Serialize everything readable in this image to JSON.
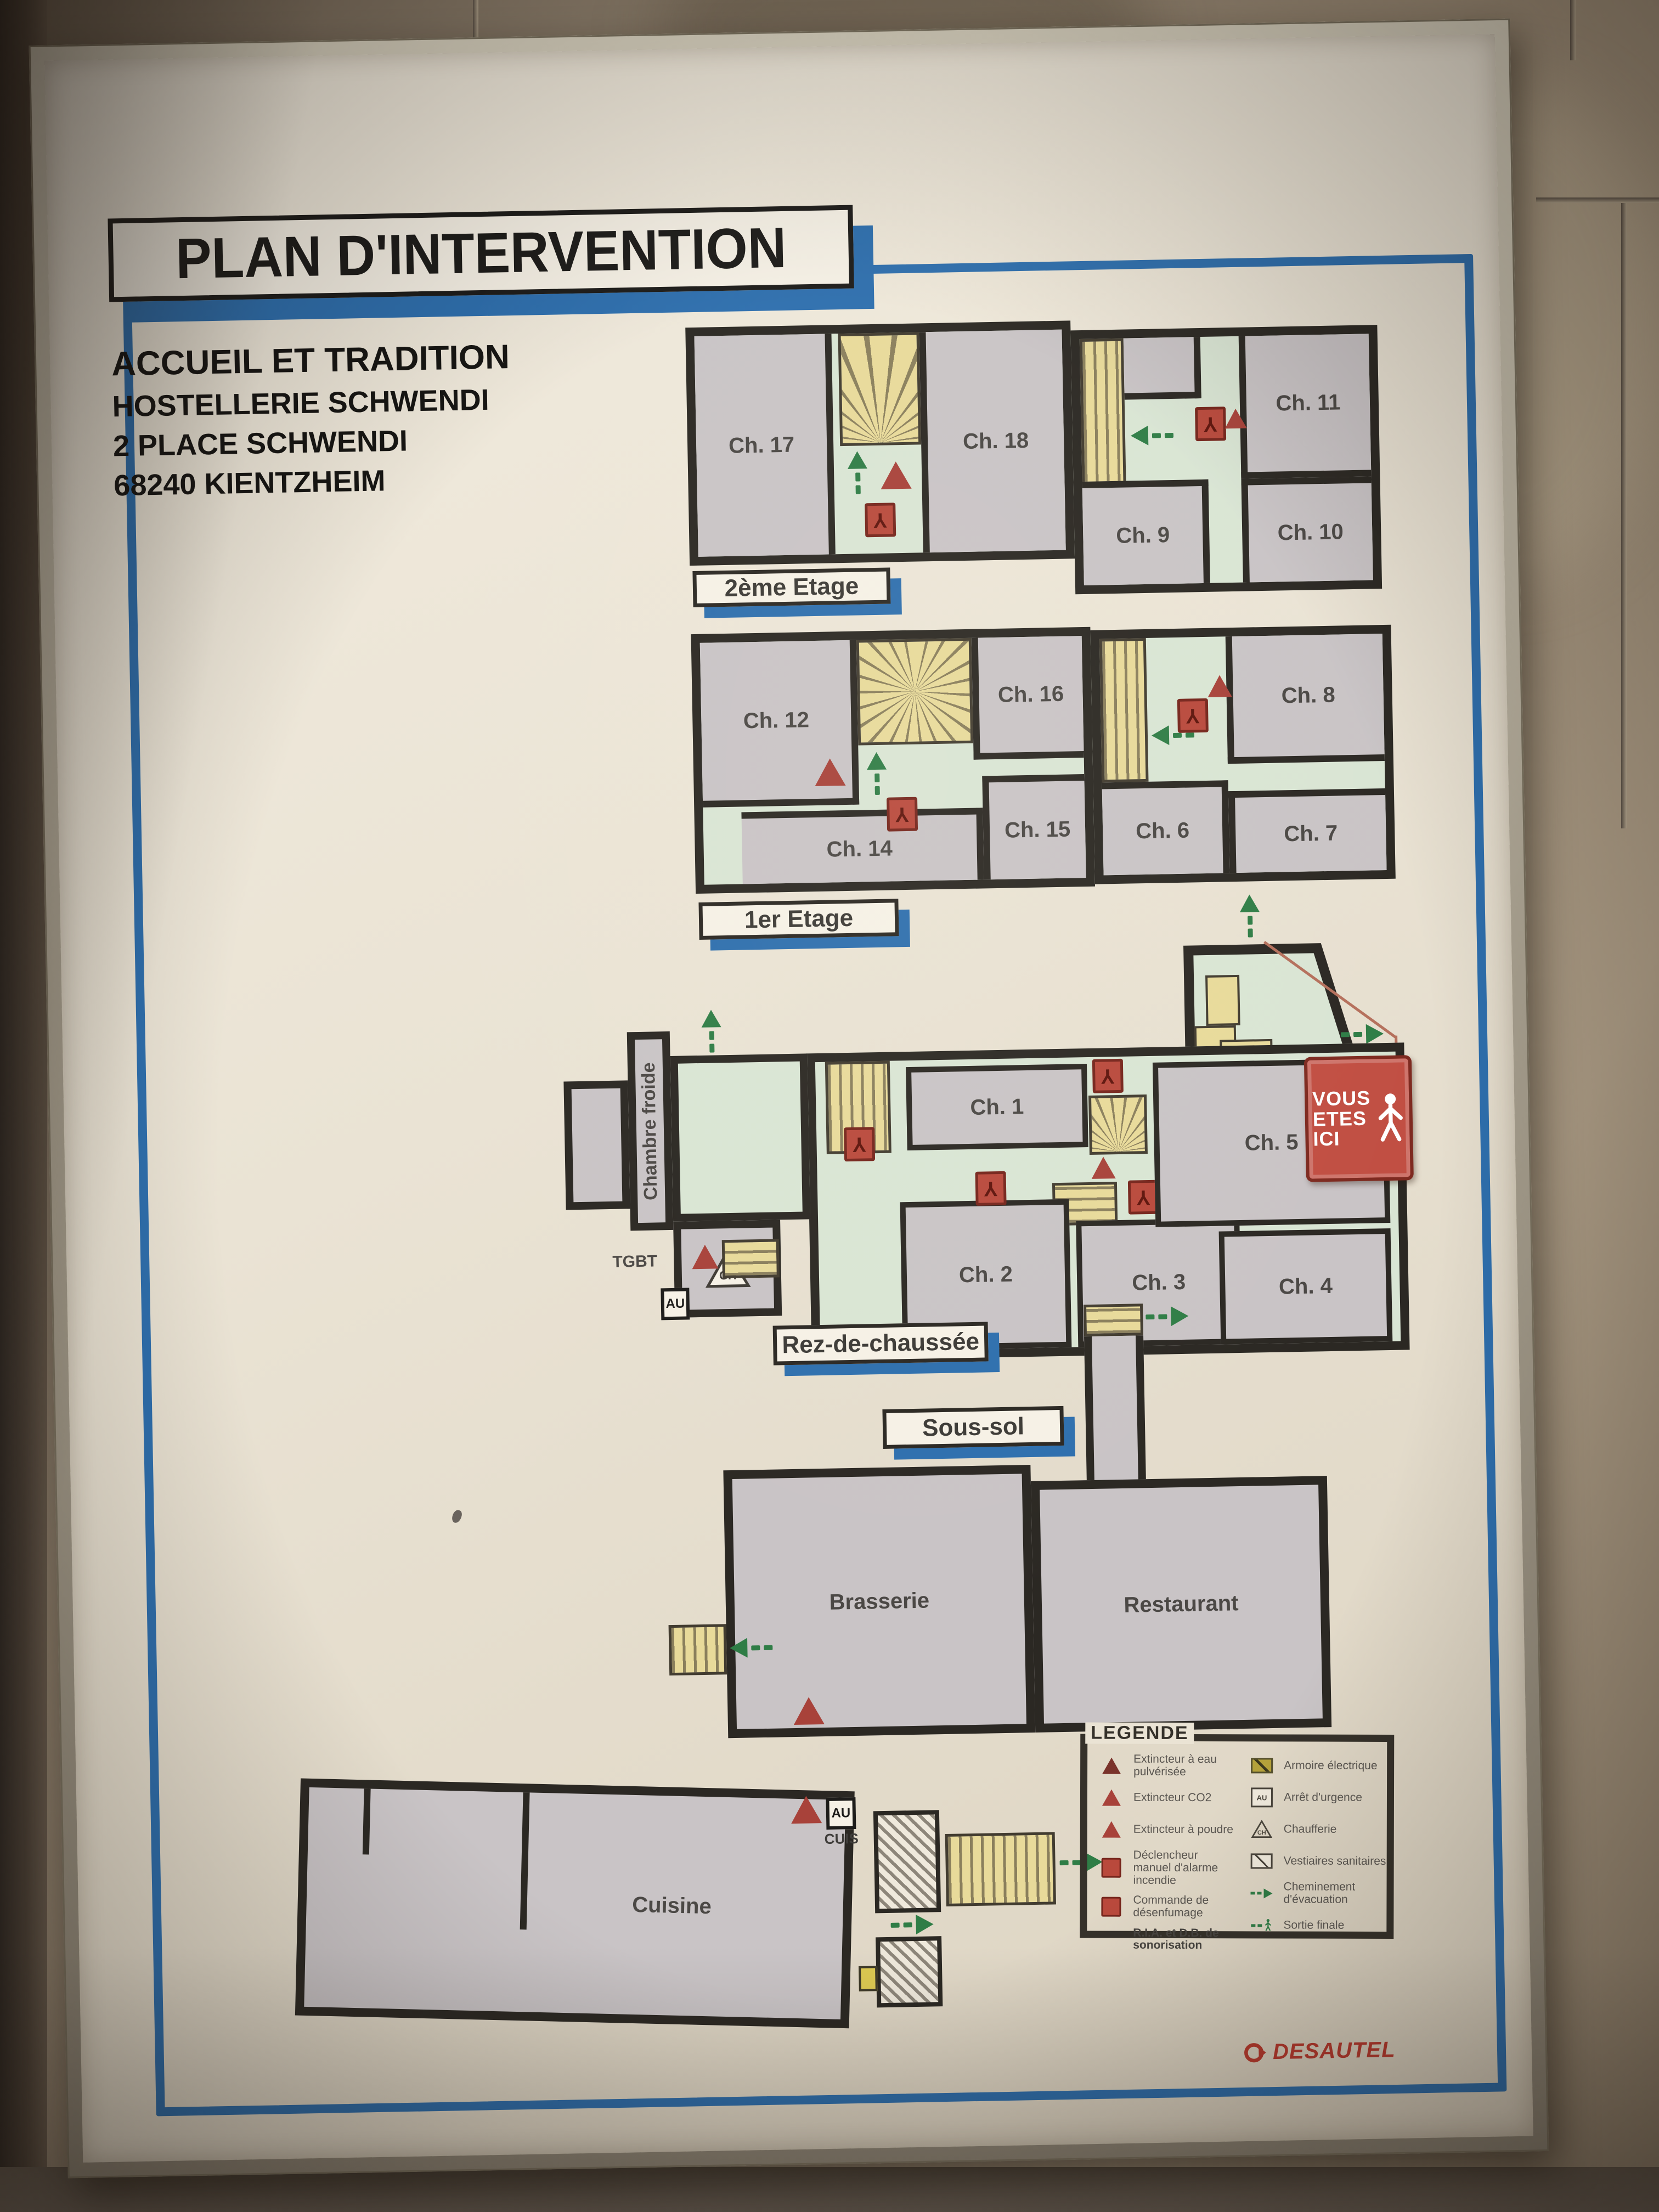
{
  "title": "PLAN D'INTERVENTION",
  "address": [
    "ACCUEIL ET TRADITION",
    "HOSTELLERIE SCHWENDI",
    "2 PLACE SCHWENDI",
    "68240 KIENTZHEIM"
  ],
  "floors": {
    "etage2": "2ème Etage",
    "etage1": "1er Etage",
    "rdc": "Rez-de-chaussée",
    "soussol": "Sous-sol"
  },
  "rooms": {
    "ch1": "Ch. 1",
    "ch2": "Ch. 2",
    "ch3": "Ch. 3",
    "ch4": "Ch. 4",
    "ch5": "Ch. 5",
    "ch6": "Ch. 6",
    "ch7": "Ch. 7",
    "ch8": "Ch. 8",
    "ch9": "Ch. 9",
    "ch10": "Ch. 10",
    "ch11": "Ch. 11",
    "ch12": "Ch. 12",
    "ch14": "Ch. 14",
    "ch15": "Ch. 15",
    "ch16": "Ch. 16",
    "ch17": "Ch. 17",
    "ch18": "Ch. 18",
    "chambre_froide": "Chambre froide",
    "brasserie": "Brasserie",
    "restaurant": "Restaurant",
    "cuisine": "Cuisine"
  },
  "annotations": {
    "tgbt": "TGBT",
    "au": "AU",
    "cuis": "CUIS",
    "ch": "CH"
  },
  "you_are_here": {
    "line1": "VOUS",
    "line2": "ETES",
    "line3": "ICI"
  },
  "legend": {
    "title": "LEGENDE",
    "left": [
      "Extincteur à eau pulvérisée",
      "Extincteur CO2",
      "Extincteur à poudre",
      "Déclencheur manuel d'alarme incendie",
      "Commande de désenfumage",
      "R.I.A. et D.B. de sonorisation"
    ],
    "right": [
      "Armoire électrique",
      "Arrêt d'urgence",
      "Chaufferie",
      "Vestiaires sanitaires",
      "Cheminement d'évacuation",
      "Sortie finale"
    ]
  },
  "brand": "DESAUTEL",
  "colors": {
    "accent_blue": "#2e6fae",
    "wall": "#2b2823",
    "room_gray": "#c9c4c6",
    "corridor_green": "#d9e5d4",
    "stair_yellow": "#e8da9a",
    "alarm_red": "#a8423a",
    "evac_green": "#2f7d46",
    "sign_red": "#c14f43"
  }
}
